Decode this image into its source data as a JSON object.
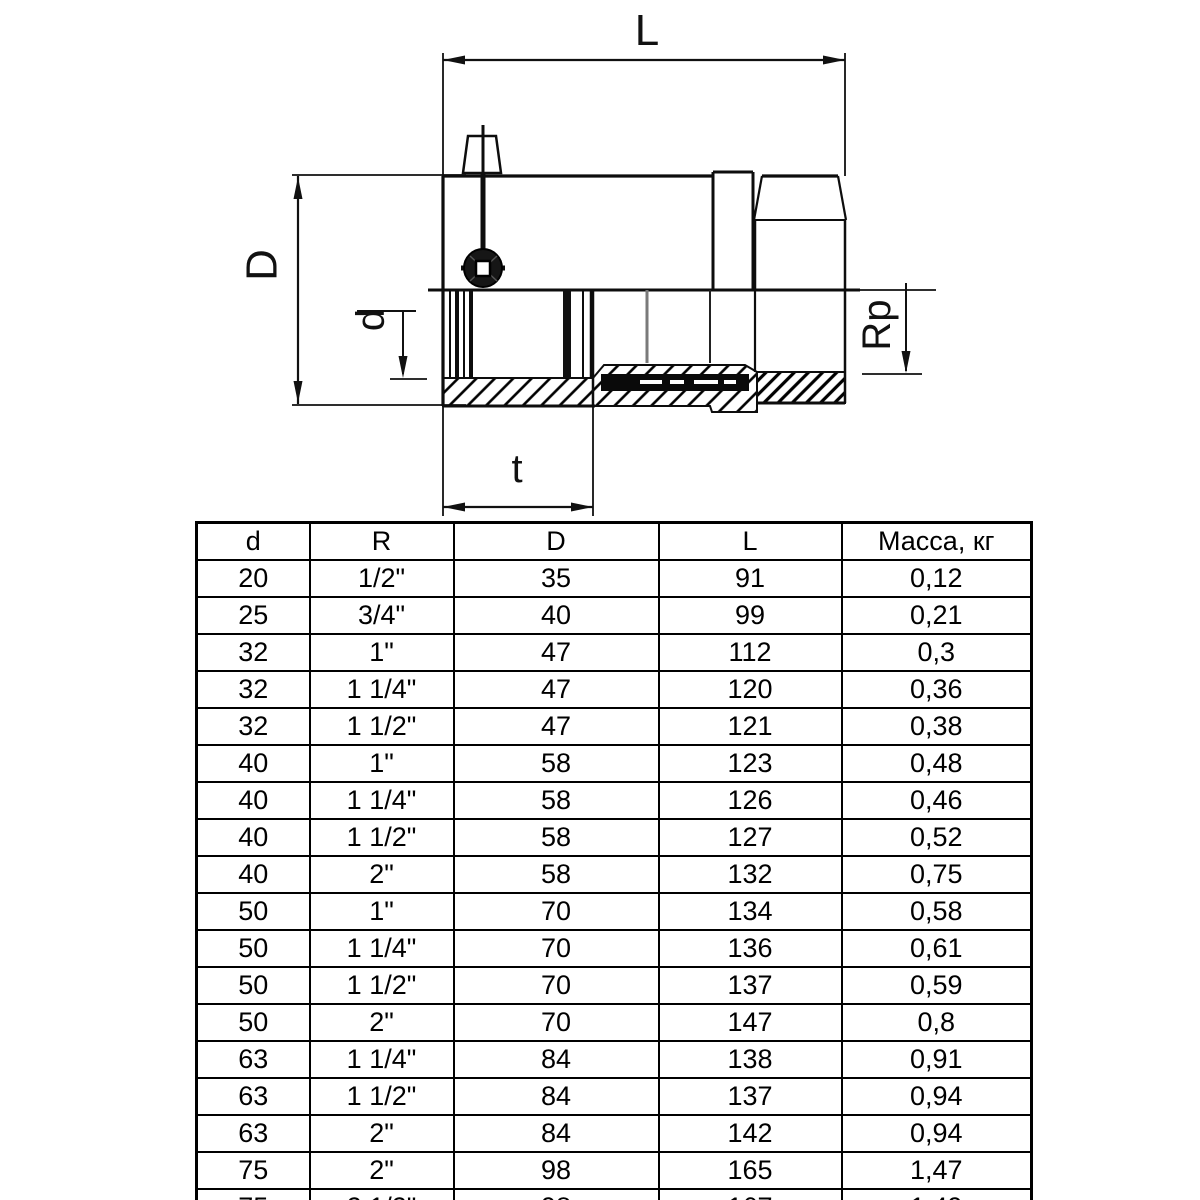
{
  "diagram": {
    "labels": {
      "length": "L",
      "outer_diameter": "D",
      "inner_diameter": "d",
      "thread": "Rp",
      "insertion_depth": "t"
    },
    "colors": {
      "line": "#000000",
      "background": "#ffffff",
      "coil_fill": "#0a0a0a",
      "lead_gray": "#7a7a7a"
    }
  },
  "table": {
    "headers": [
      "d",
      "R",
      "D",
      "L",
      "Масса, кг"
    ],
    "rows": [
      [
        "20",
        "1/2\"",
        "35",
        "91",
        "0,12"
      ],
      [
        "25",
        "3/4\"",
        "40",
        "99",
        "0,21"
      ],
      [
        "32",
        "1\"",
        "47",
        "112",
        "0,3"
      ],
      [
        "32",
        "1 1/4\"",
        "47",
        "120",
        "0,36"
      ],
      [
        "32",
        "1 1/2\"",
        "47",
        "121",
        "0,38"
      ],
      [
        "40",
        "1\"",
        "58",
        "123",
        "0,48"
      ],
      [
        "40",
        "1 1/4\"",
        "58",
        "126",
        "0,46"
      ],
      [
        "40",
        "1 1/2\"",
        "58",
        "127",
        "0,52"
      ],
      [
        "40",
        "2\"",
        "58",
        "132",
        "0,75"
      ],
      [
        "50",
        "1\"",
        "70",
        "134",
        "0,58"
      ],
      [
        "50",
        "1 1/4\"",
        "70",
        "136",
        "0,61"
      ],
      [
        "50",
        "1 1/2\"",
        "70",
        "137",
        "0,59"
      ],
      [
        "50",
        "2\"",
        "70",
        "147",
        "0,8"
      ],
      [
        "63",
        "1 1/4\"",
        "84",
        "138",
        "0,91"
      ],
      [
        "63",
        "1 1/2\"",
        "84",
        "137",
        "0,94"
      ],
      [
        "63",
        "2\"",
        "84",
        "142",
        "0,94"
      ],
      [
        "75",
        "2\"",
        "98",
        "165",
        "1,47"
      ],
      [
        "75",
        "2 1/2\"",
        "98",
        "167",
        "1,49"
      ]
    ]
  }
}
